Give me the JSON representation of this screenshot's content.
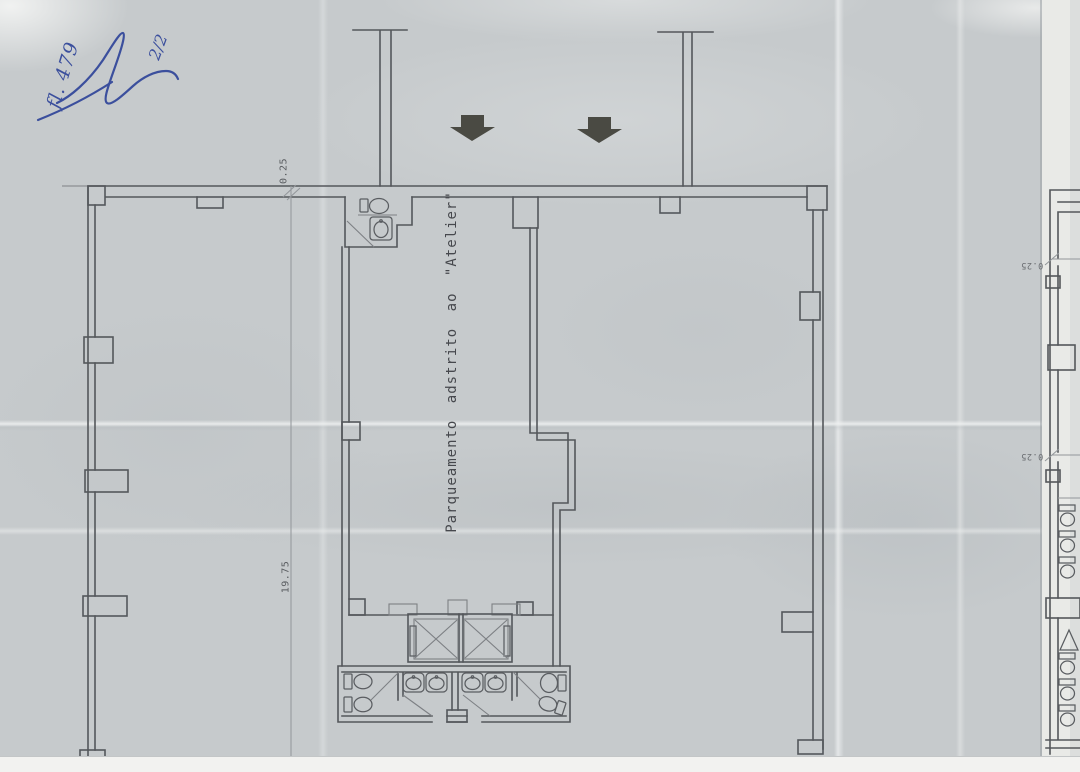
{
  "annotations": {
    "folio": "fl. 479",
    "page_fraction": "2/2"
  },
  "plan": {
    "room_label": "Parqueamento adstrito ao \"Atelier\"",
    "dimensions": {
      "wall_thickness": "0.25",
      "length": "19.75"
    }
  },
  "adjacent_plan": {
    "dimensions": {
      "upper": "0.25",
      "lower": "0.25"
    }
  },
  "icons": {
    "entry_arrows": [
      "down-arrow-icon",
      "down-arrow-icon"
    ],
    "fixtures": [
      "toilet-icon",
      "sink-icon",
      "elevator-shaft-icon",
      "urinal-icon",
      "door-swing-icon"
    ]
  },
  "colors": {
    "paper": "#c6cacc",
    "scan_edge": "#f2f2f0",
    "line": "#54575b",
    "arrow": "#4a4a43",
    "handwriting": "#3b4f9d"
  }
}
